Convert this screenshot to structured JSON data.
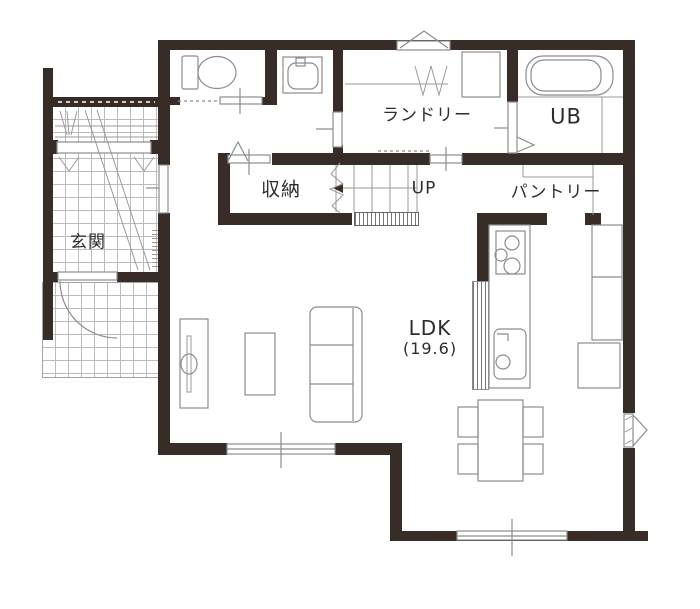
{
  "plan": {
    "rooms": [
      {
        "id": "genkan",
        "label": "玄関"
      },
      {
        "id": "storage",
        "label": "収納"
      },
      {
        "id": "stairs",
        "label": "UP"
      },
      {
        "id": "laundry",
        "label": "ランドリー"
      },
      {
        "id": "bath",
        "label": "UB"
      },
      {
        "id": "pantry",
        "label": "パントリー"
      },
      {
        "id": "ldk",
        "label": "LDK",
        "area": "(19.6)"
      }
    ],
    "colors": {
      "wall": "#382c26",
      "line": "#8c8c8c",
      "tile": "#bcbcbc",
      "text": "#2d2d2d",
      "bg": "#ffffff"
    },
    "fixtures": [
      "toilet-icon",
      "washbasin-icon",
      "washing-machine-pan-icon",
      "bathtub-icon",
      "hanger-pipe-icon",
      "stairs-icon",
      "gas-stove-icon",
      "kitchen-sink-icon",
      "refrigerator-icon",
      "cupboard-icon",
      "dining-table-icon",
      "chair-icon",
      "sofa-icon",
      "living-table-icon",
      "tv-board-icon",
      "entrance-door-icon",
      "sliding-door-icon",
      "window-icon",
      "vent-triangle-icon"
    ]
  }
}
